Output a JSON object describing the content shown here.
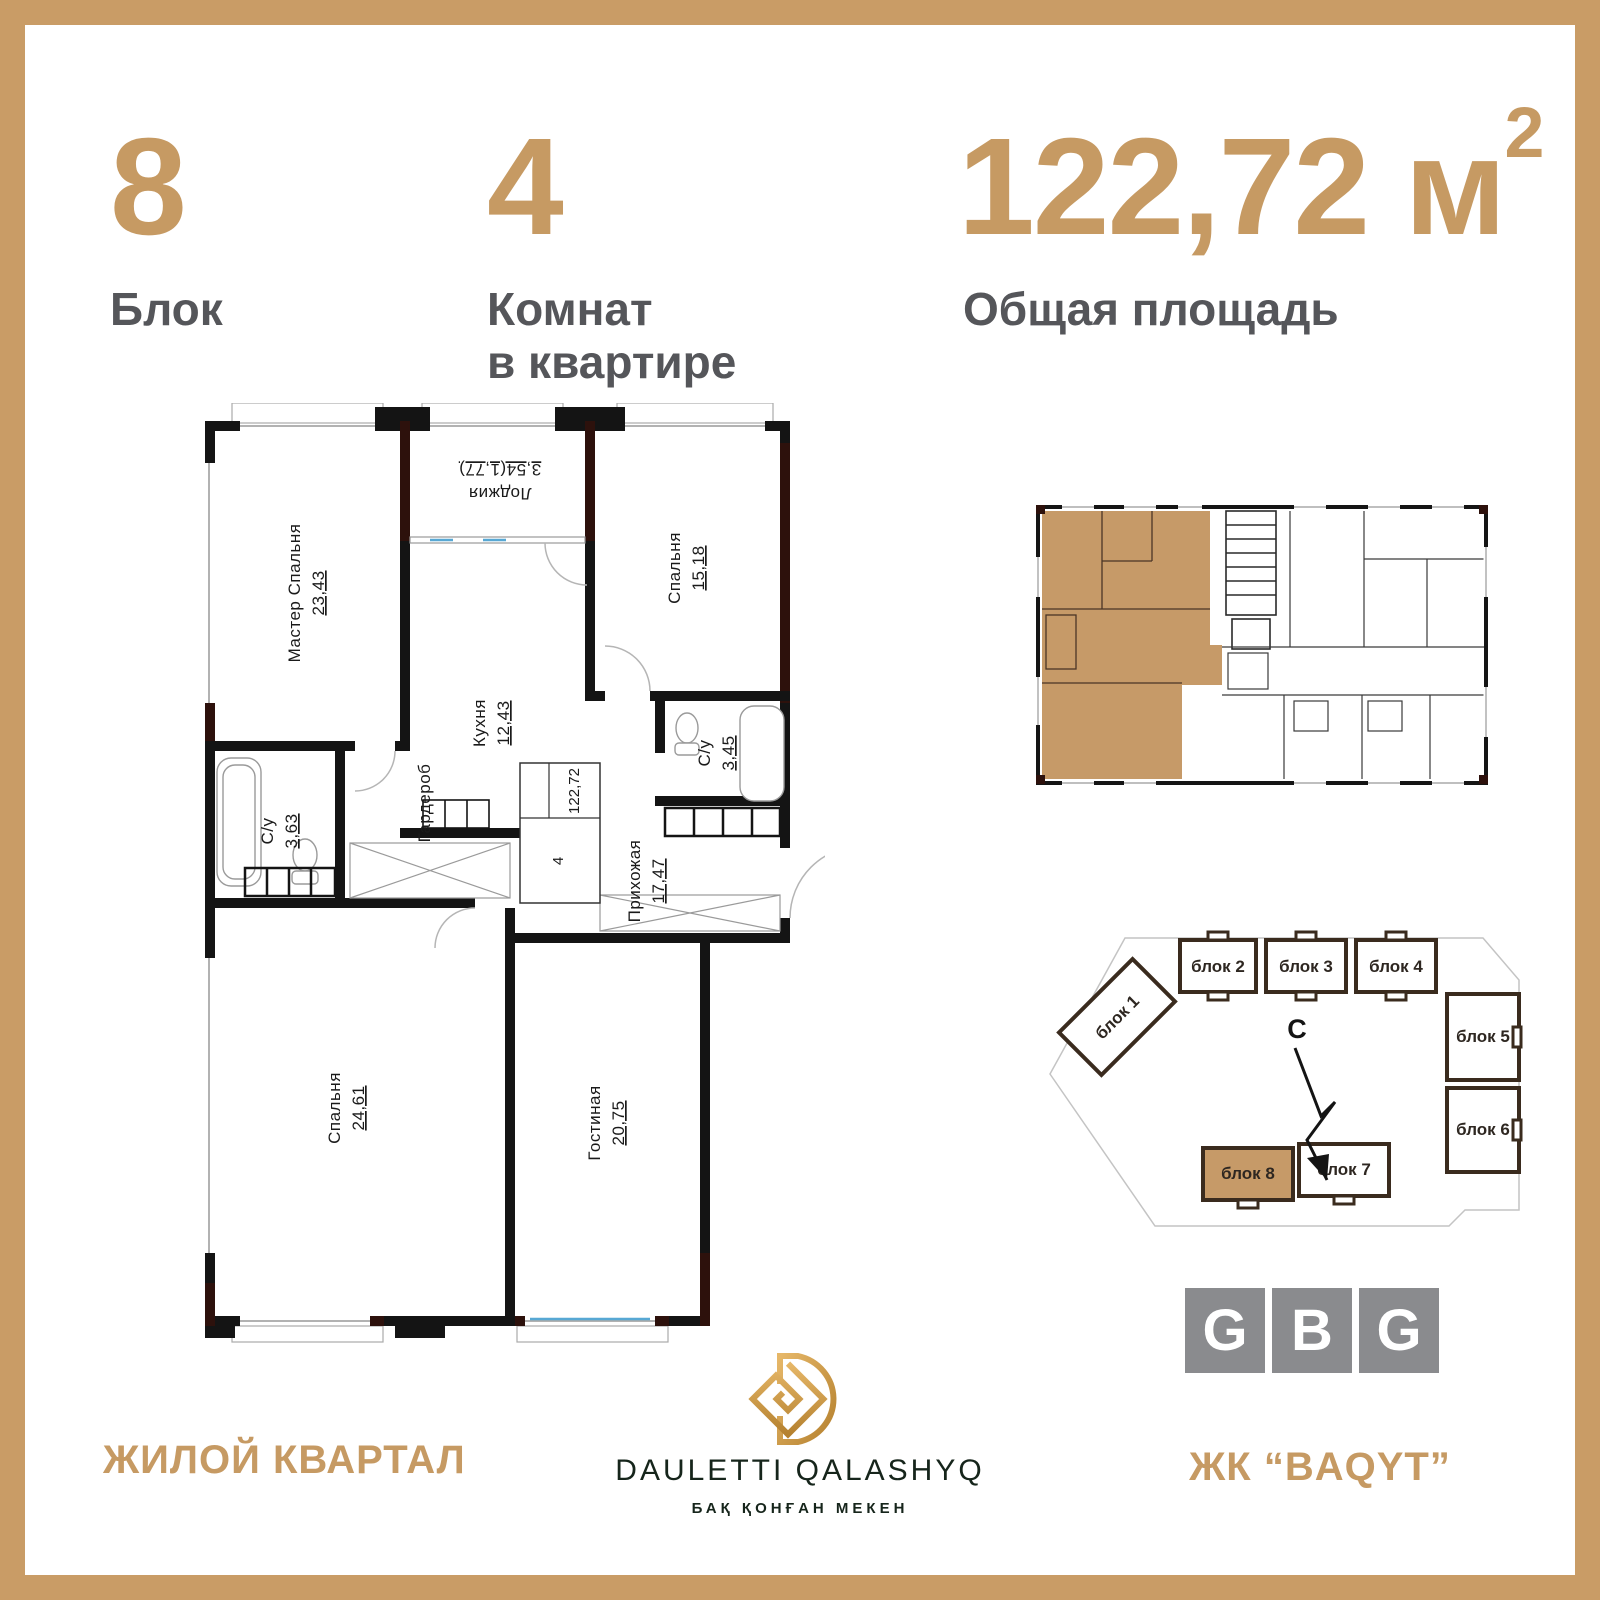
{
  "colors": {
    "accent": "#C69A63",
    "label_gray": "#55565A",
    "highlight_tan": "#C69A68",
    "wall_black": "#141414",
    "wall_maroon": "#2D110C",
    "site_outline": "#3A2B1E",
    "gbg_gray": "#8A8B8E",
    "brand_dark": "#16251B",
    "glazing_blue": "#57A8D4"
  },
  "header": {
    "block_value": "8",
    "block_label": "Блок",
    "rooms_value": "4",
    "rooms_label_line1": "Комнат",
    "rooms_label_line2": "в квартире",
    "area_value": "122,72",
    "area_unit": "м",
    "area_sup": "2",
    "area_label": "Общая площадь"
  },
  "floorplan": {
    "rooms": [
      {
        "name": "Мастер Спальня",
        "area": "23,43"
      },
      {
        "name": "Лоджия",
        "area": "3,54(1,77)"
      },
      {
        "name": "Кухня",
        "area": "12,43"
      },
      {
        "name": "Спальня",
        "area": "15,18"
      },
      {
        "name": "С/у",
        "area": "3,45"
      },
      {
        "name": "С/у",
        "area": "3,63"
      },
      {
        "name": "Гардероб",
        "area": ""
      },
      {
        "name": "Прихожая",
        "area": "17,47"
      },
      {
        "name": "Спальня",
        "area": "24,61"
      },
      {
        "name": "Гостиная",
        "area": "20,75"
      }
    ],
    "stamp": {
      "total_area": "122,72",
      "rooms_count": "4"
    }
  },
  "siteplan": {
    "compass": "С",
    "blocks": [
      {
        "label": "блок 1",
        "highlighted": false
      },
      {
        "label": "блок 2",
        "highlighted": false
      },
      {
        "label": "блок 3",
        "highlighted": false
      },
      {
        "label": "блок 4",
        "highlighted": false
      },
      {
        "label": "блок 5",
        "highlighted": false
      },
      {
        "label": "блок 6",
        "highlighted": false
      },
      {
        "label": "блок 7",
        "highlighted": false
      },
      {
        "label": "блок 8",
        "highlighted": true
      }
    ]
  },
  "footer": {
    "left_text": "ЖИЛОЙ КВАРТАЛ",
    "right_text": "ЖК “BAQYT”",
    "brand_name": "DAULETTI QALASHYQ",
    "brand_tagline": "БАҚ ҚОНҒАН МЕКЕН"
  },
  "gbg": {
    "letters": [
      "G",
      "B",
      "G"
    ]
  }
}
